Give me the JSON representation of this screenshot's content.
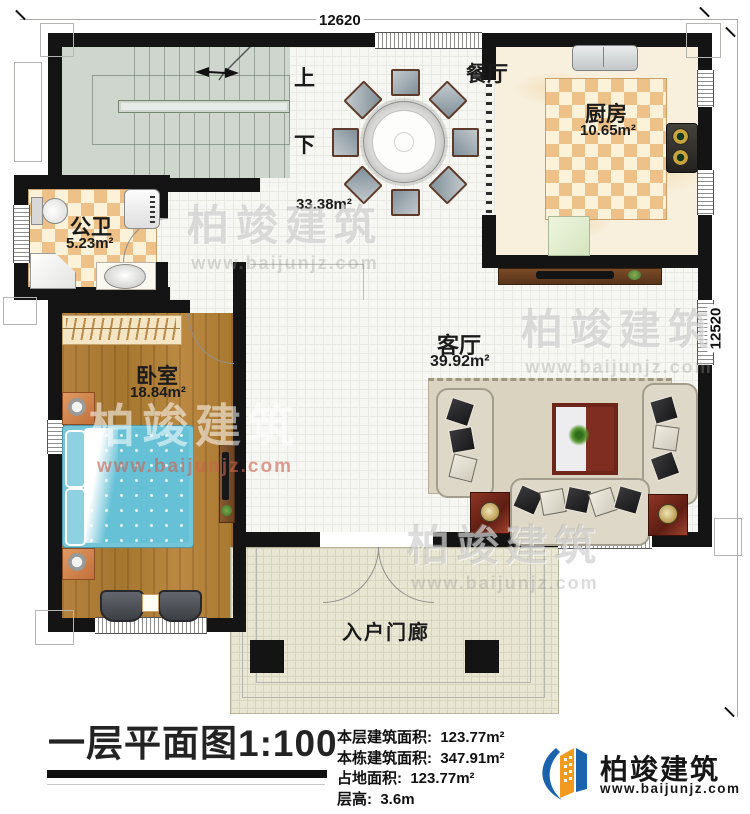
{
  "dimensions": {
    "top": "12620",
    "right": "12520"
  },
  "rooms": [
    {
      "name": "餐厅",
      "area": "33.38m²"
    },
    {
      "name": "厨房",
      "area": "10.65m²"
    },
    {
      "name": "公卫",
      "area": "5.23m²"
    },
    {
      "name": "卧室",
      "area": "18.84m²"
    },
    {
      "name": "客厅",
      "area": "39.92m²"
    },
    {
      "name": "入户门廊",
      "area": ""
    }
  ],
  "stairs": {
    "up": "上",
    "down": "下"
  },
  "title_block": {
    "title": "一层平面图",
    "scale": "1:100",
    "stats": [
      {
        "label": "本层建筑面积:",
        "value": "123.77m²"
      },
      {
        "label": "本栋建筑面积:",
        "value": "347.91m²"
      },
      {
        "label": "占地面积:",
        "value": "123.77m²"
      },
      {
        "label": "层高:",
        "value": "3.6m"
      }
    ]
  },
  "branding": {
    "company": "柏竣建筑",
    "website": "www.baijunjz.com"
  },
  "watermark": {
    "text": "柏竣建筑",
    "url": "www.baijunjz.com"
  },
  "furniture": {
    "dining_chair_count": 8
  }
}
